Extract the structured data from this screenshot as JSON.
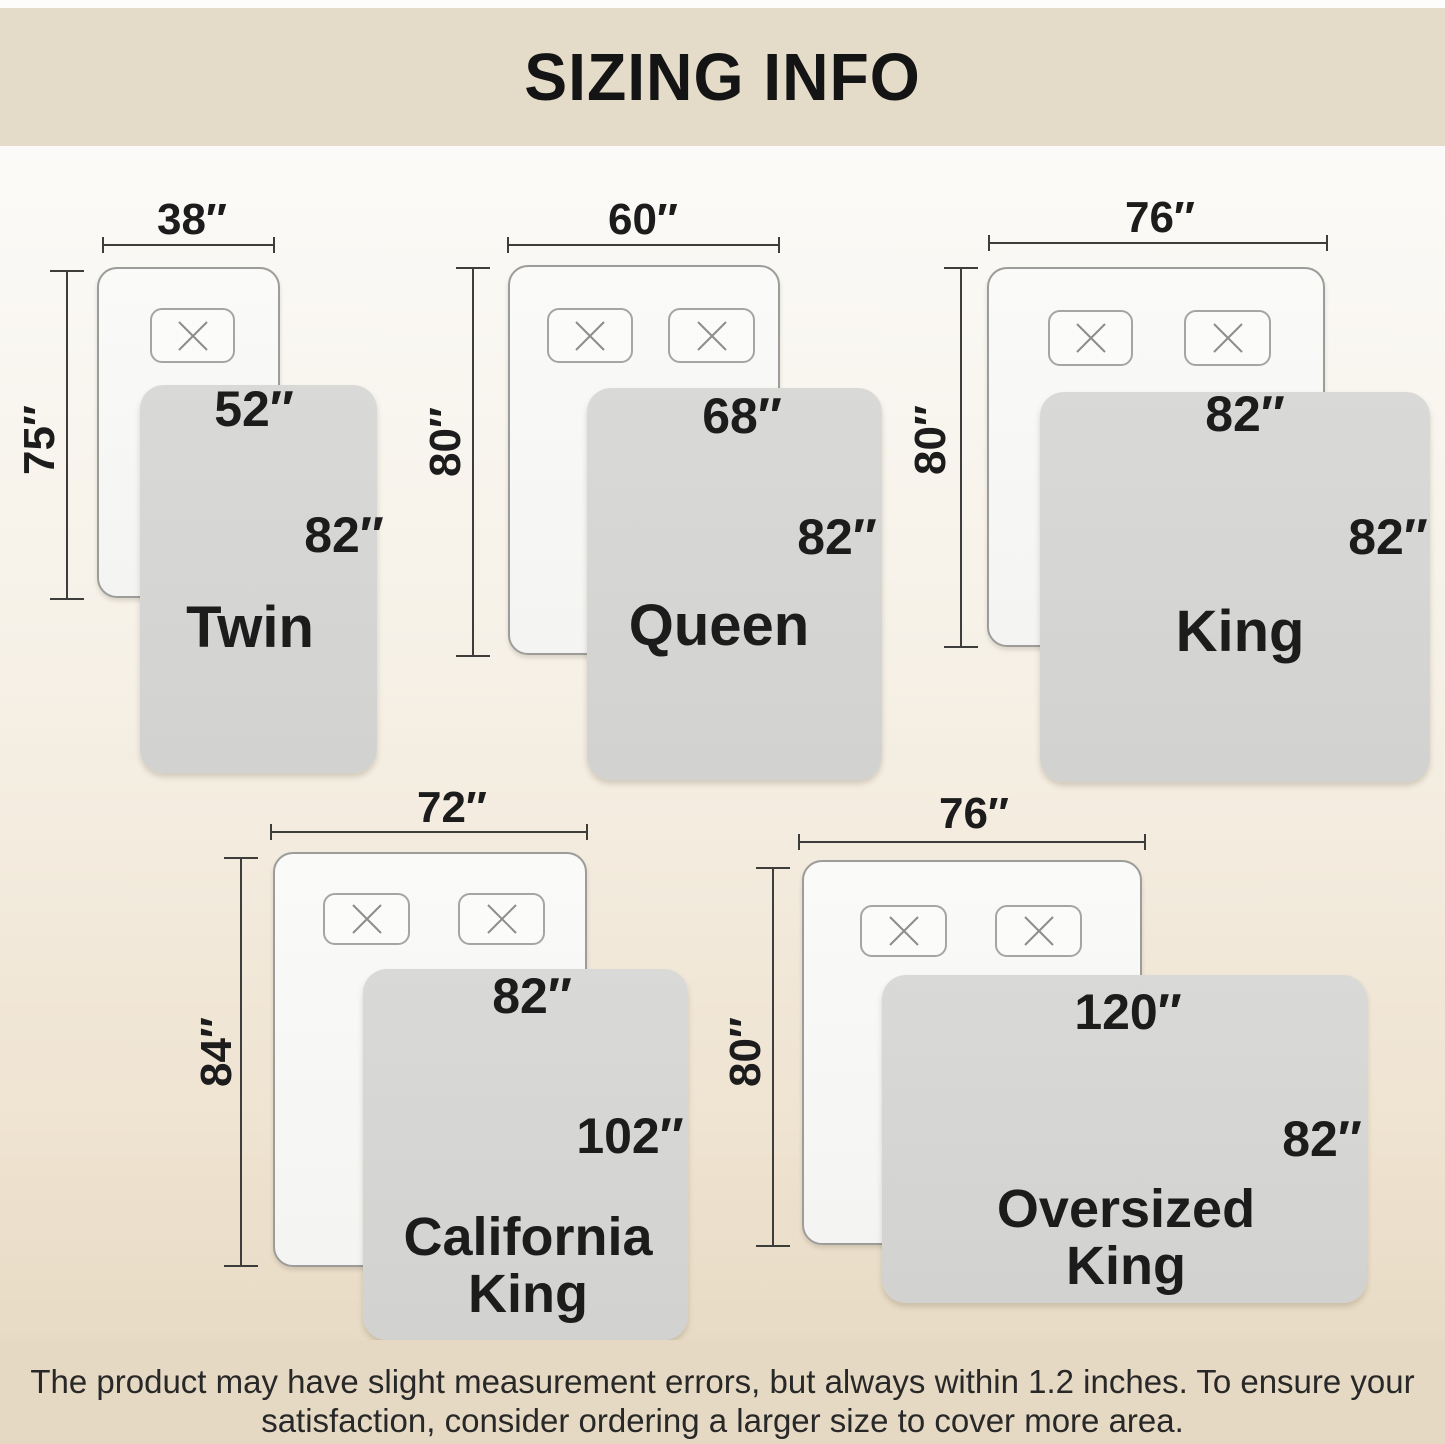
{
  "title": "SIZING INFO",
  "footer": {
    "line1": "The product may have slight measurement errors, but always within 1.2 inches. To ensure your",
    "line2": "satisfaction, consider ordering a larger size to cover more area."
  },
  "colors": {
    "header_band": "#e4dbc8",
    "footer_band": "#e6d9c4",
    "bed_fill": "#f7f7f5",
    "bed_border": "#9c9c9a",
    "blanket_fill": "#d6d6d4",
    "text": "#1c1c1c"
  },
  "sizes": [
    {
      "name": "Twin",
      "label_lines": [
        "Twin"
      ],
      "bed_width": "38″",
      "bed_height": "75″",
      "blanket_width": "52″",
      "blanket_height": "82″"
    },
    {
      "name": "Queen",
      "label_lines": [
        "Queen"
      ],
      "bed_width": "60″",
      "bed_height": "80″",
      "blanket_width": "68″",
      "blanket_height": "82″"
    },
    {
      "name": "King",
      "label_lines": [
        "King"
      ],
      "bed_width": "76″",
      "bed_height": "80″",
      "blanket_width": "82″",
      "blanket_height": "82″"
    },
    {
      "name": "California King",
      "label_lines": [
        "California",
        "King"
      ],
      "bed_width": "72″",
      "bed_height": "84″",
      "blanket_width": "82″",
      "blanket_height": "102″"
    },
    {
      "name": "Oversized King",
      "label_lines": [
        "Oversized",
        "King"
      ],
      "bed_width": "76″",
      "bed_height": "80″",
      "blanket_width": "120″",
      "blanket_height": "82″"
    }
  ]
}
